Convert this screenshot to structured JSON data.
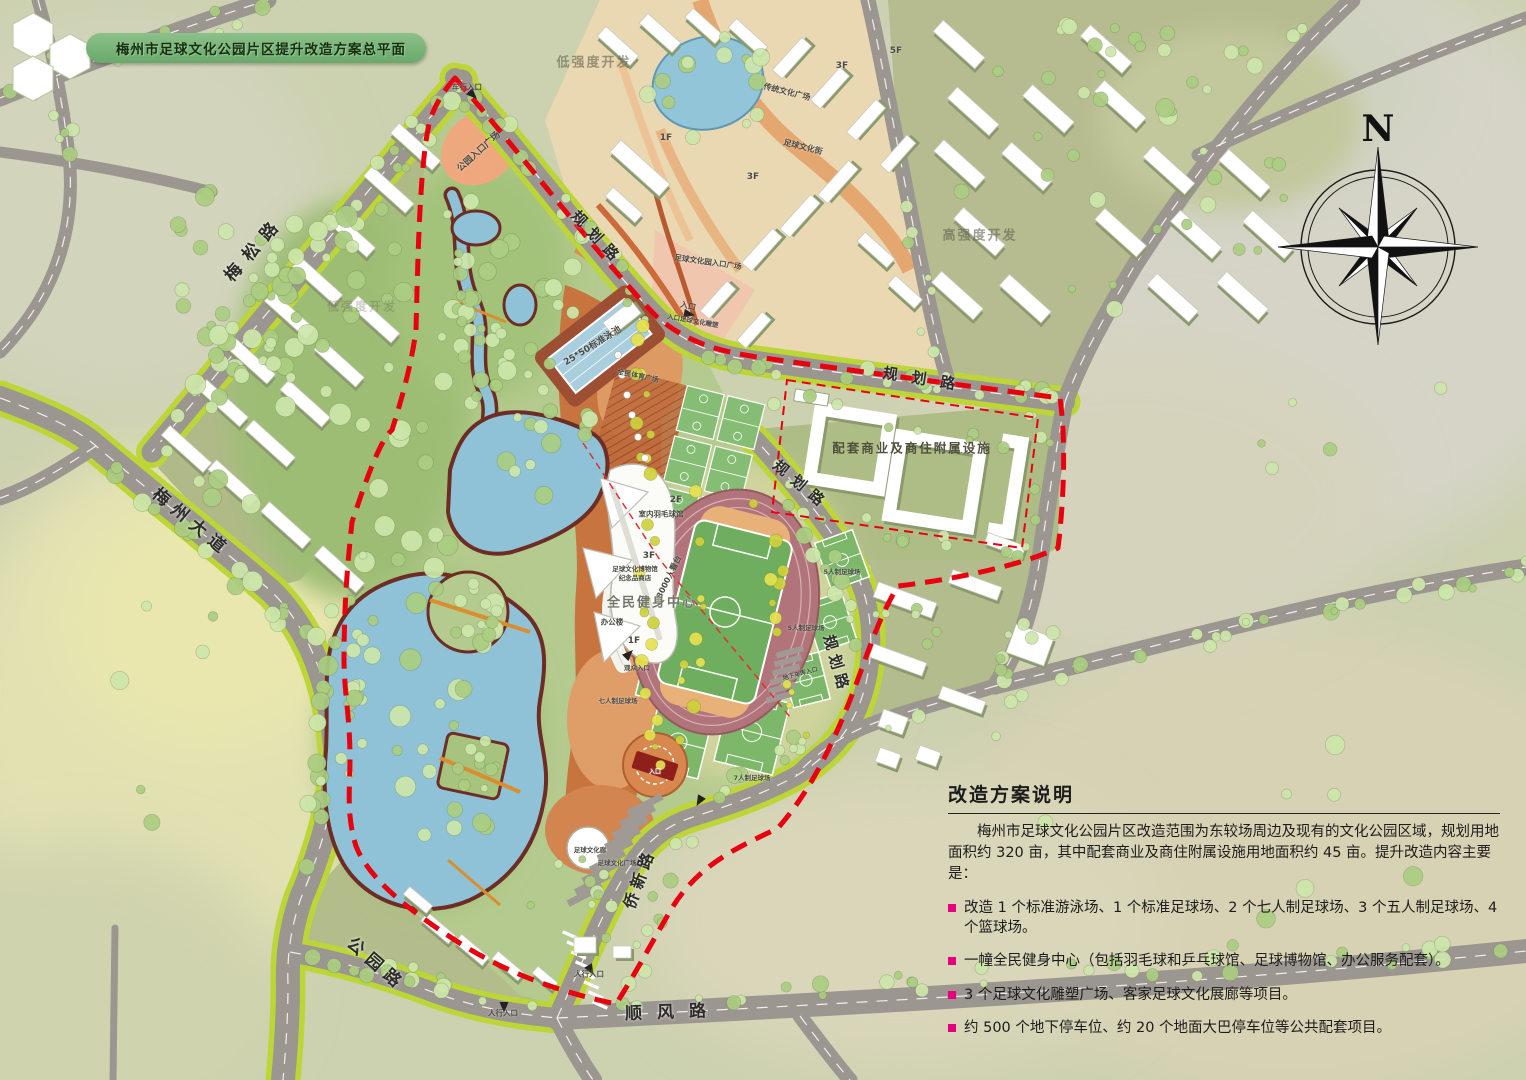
{
  "title": "梅州市足球文化公园片区提升改造方案总平面",
  "compass": {
    "north": "N"
  },
  "roads": {
    "meisong": "梅松路",
    "meizhou_avenue": "梅州大道",
    "gongyuan": "公园路",
    "shunfeng": "顺风路",
    "qiaoxin": "侨新路",
    "guihua_nw": "规划路",
    "guihua_n": "规划路",
    "guihua_mid": "规划路",
    "guihua_e": "规划路"
  },
  "zones": {
    "low_intensity_1": "低强度开发",
    "low_intensity_2": "低强度开发",
    "high_intensity": "高强度开发",
    "commercial": "配套商业及商住附属设施"
  },
  "site_labels": [
    {
      "text": "公园入口广场"
    },
    {
      "text": "车行入口"
    },
    {
      "text": "入口"
    },
    {
      "text": "传统文化广场"
    },
    {
      "text": "足球文化街"
    },
    {
      "text": "足球文化园入口广场"
    },
    {
      "text": "25*50标准泳池"
    },
    {
      "text": "室内羽毛球馆"
    },
    {
      "text": "2F"
    },
    {
      "text": "3F"
    },
    {
      "text": "足球文化博物馆"
    },
    {
      "text": "纪念品商店"
    },
    {
      "text": "3000人看台"
    },
    {
      "text": "全民健身中心"
    },
    {
      "text": "办公楼"
    },
    {
      "text": "1F"
    },
    {
      "text": "七人制足球场"
    },
    {
      "text": "7人制足球场"
    },
    {
      "text": "5人制足球场"
    },
    {
      "text": "5人制足球场"
    },
    {
      "text": "足球文化廊"
    },
    {
      "text": "足球文化广场"
    },
    {
      "text": "人行入口"
    },
    {
      "text": "人行入口"
    },
    {
      "text": "5F"
    },
    {
      "text": "3F"
    },
    {
      "text": "1F"
    },
    {
      "text": "3F"
    },
    {
      "text": "入口足球文化雕塑"
    },
    {
      "text": "全民体育广场"
    },
    {
      "text": "观众入口"
    },
    {
      "text": "地下车库入口"
    },
    {
      "text": "入口"
    }
  ],
  "notes": {
    "heading": "改造方案说明",
    "paragraph": "梅州市足球文化公园片区改造范围为东较场周边及现有的文化公园区域，规划用地面积约 320 亩，其中配套商业及商住附属设施用地面积约 45 亩。提升改造内容主要是：",
    "bullets": [
      "改造 1 个标准游泳场、1 个标准足球场、2 个七人制足球场、3 个五人制足球场、4 个篮球场。",
      "一幢全民健身中心（包括羽毛球和乒乓球馆、足球博物馆、办公服务配套）。",
      "3 个足球文化雕塑广场、客家足球文化展廊等项目。",
      "约 500 个地下停车位、约 20 个地面大巴停车位等公共配套项目。"
    ]
  },
  "colors": {
    "boundary": "#e8000f",
    "bullet": "#e6007e",
    "title_bg": "#6fae6f",
    "road": "#9c9691",
    "verge": "#bdd637",
    "water": "#8fc2d6",
    "park_green": "#b5ca8e",
    "plaza_orange": "#c8743f",
    "track_pink": "#b2747b",
    "field_green": "#6fae5e"
  }
}
